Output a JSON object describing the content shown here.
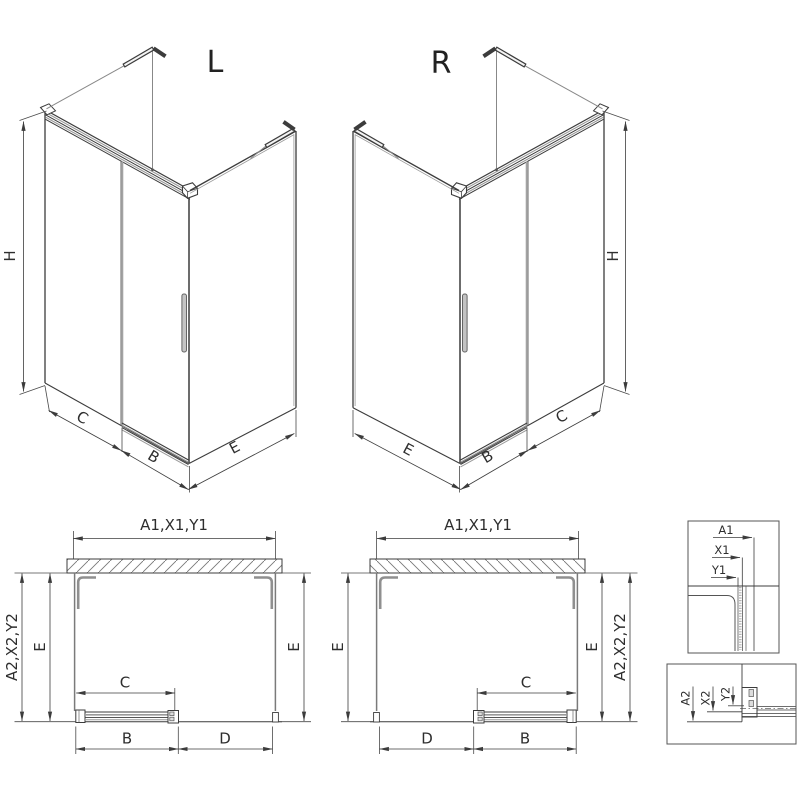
{
  "drawing": {
    "type": "shower-enclosure-technical-drawing",
    "iso_left": {
      "title": "L",
      "dim_h": "H",
      "dim_c": "C",
      "dim_b": "B",
      "dim_e": "E"
    },
    "iso_right": {
      "title": "R",
      "dim_h": "H",
      "dim_c": "C",
      "dim_b": "B",
      "dim_e": "E"
    },
    "plan_left": {
      "dim_top": "A1,X1,Y1",
      "dim_side": "A2,X2,Y2",
      "dim_e_left": "E",
      "dim_e_right": "E",
      "dim_c": "C",
      "dim_b": "B",
      "dim_d": "D"
    },
    "plan_right": {
      "dim_top": "A1,X1,Y1",
      "dim_side": "A2,X2,Y2",
      "dim_e_left": "E",
      "dim_e_right": "E",
      "dim_c": "C",
      "dim_b": "B",
      "dim_d": "D"
    },
    "detail_top": {
      "dim_a1": "A1",
      "dim_x1": "X1",
      "dim_y1": "Y1"
    },
    "detail_bottom": {
      "dim_a2": "A2",
      "dim_x2": "X2",
      "dim_y2": "Y2"
    }
  },
  "colors": {
    "line": "#3c3c3c",
    "profile_gray": "#8f8f8f",
    "glass_gray": "#9a9a9a",
    "background": "#ffffff"
  }
}
